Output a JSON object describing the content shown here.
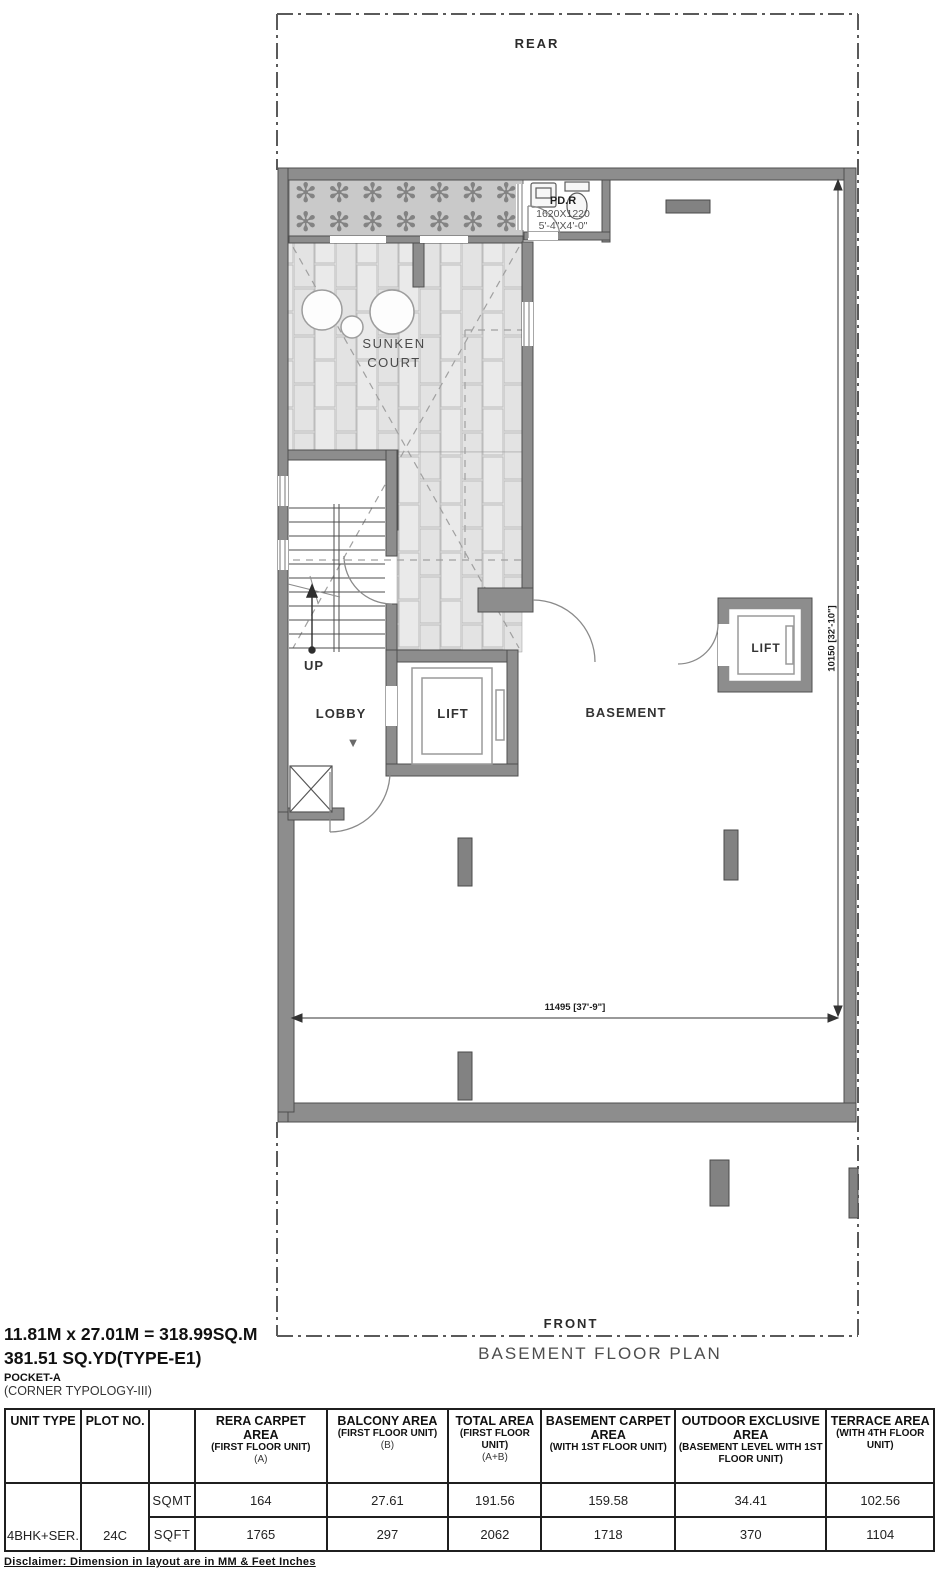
{
  "plan": {
    "rear_label": "REAR",
    "front_label": "FRONT",
    "title": "BASEMENT FLOOR PLAN",
    "labels": {
      "sunken_court_line1": "SUNKEN",
      "sunken_court_line2": "COURT",
      "lobby": "LOBBY",
      "lift": "LIFT",
      "lift2": "LIFT",
      "basement": "BASEMENT",
      "up": "UP"
    },
    "pdr": {
      "name": "PD.R",
      "dim_mm": "1620X1220",
      "dim_ft": "5'-4\"X4'-0\""
    },
    "dimensions": {
      "width": "11495 [37'-9\"]",
      "height": "10150 [32'-10\"]"
    },
    "planting": {
      "glyph": "✻"
    },
    "lobby_arrow": "▼"
  },
  "summary": {
    "line1": "11.81M x 27.01M = 318.99SQ.M",
    "line2": "381.51 SQ.YD(TYPE-E1)",
    "line3": "POCKET-A",
    "line4": "(CORNER TYPOLOGY-III)"
  },
  "table": {
    "headers": {
      "unit_type": "UNIT TYPE",
      "plot_no": "PLOT NO.",
      "rera_title": "RERA CARPET AREA",
      "rera_sub": "(FIRST FLOOR UNIT)",
      "rera_note": "(A)",
      "balcony_title": "BALCONY AREA",
      "balcony_sub": "(FIRST FLOOR UNIT)",
      "balcony_note": "(B)",
      "total_title": "TOTAL AREA",
      "total_sub": "(FIRST FLOOR UNIT)",
      "total_note": "(A+B)",
      "basement_title": "BASEMENT CARPET AREA",
      "basement_sub": "(WITH 1ST FLOOR UNIT)",
      "outdoor_title": "OUTDOOR EXCLUSIVE AREA",
      "outdoor_sub": "(BASEMENT LEVEL WITH 1ST FLOOR UNIT)",
      "terrace_title": "TERRACE AREA",
      "terrace_sub": "(WITH 4TH FLOOR UNIT)"
    },
    "unit_type_value": "4BHK+SER.",
    "plot_no_value": "24C",
    "rows": [
      {
        "unit": "SQMT",
        "values": [
          "164",
          "27.61",
          "191.56",
          "159.58",
          "34.41",
          "102.56"
        ]
      },
      {
        "unit": "SQFT",
        "values": [
          "1765",
          "297",
          "2062",
          "1718",
          "370",
          "1104"
        ]
      }
    ]
  },
  "disclaimer": "Disclaimer: Dimension in layout are in MM & Feet Inches"
}
